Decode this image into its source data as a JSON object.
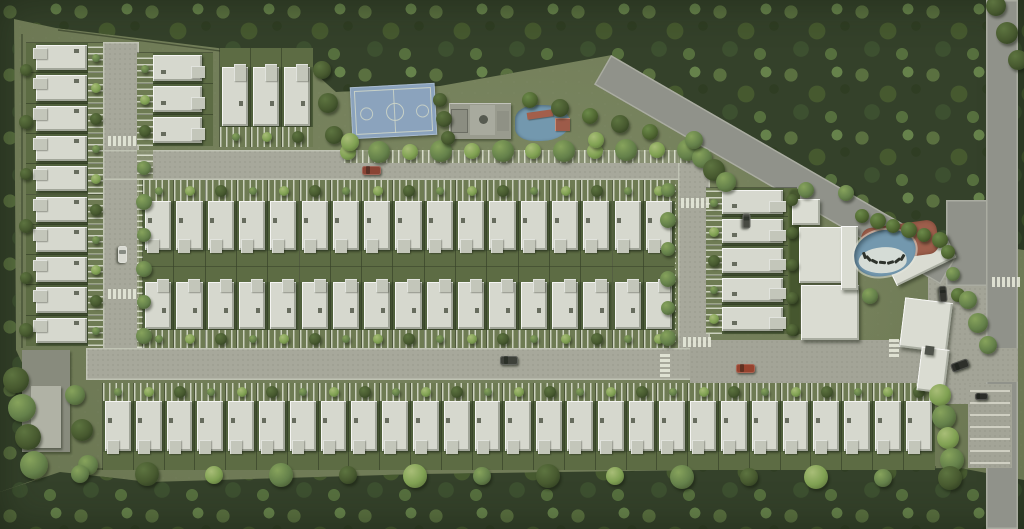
{
  "canvas": {
    "w": 1024,
    "h": 529
  },
  "palette": {
    "grass": "#75815a",
    "forest": "#34412a",
    "asphalt": "#90928a",
    "paver": "#a7a89b",
    "plaza": "#a3a497",
    "roof_white": "#d6d8ce",
    "yard_green": "#5d6c44",
    "court_blue": "#8ba3bd",
    "court_line": "#d6dbc8",
    "pool_blue": "#7398ae",
    "deck_terracotta": "#9d5f4c",
    "pool_rim": "#e3e5da",
    "wall_line": "#333d26",
    "car_red": "#8a4434",
    "car_dark": "#3e413a",
    "car_white": "#d8d9d1"
  },
  "forest_shapes": [
    {
      "name": "forest-top",
      "points": [
        [
          0,
          0
        ],
        [
          1024,
          0
        ],
        [
          1024,
          250
        ],
        [
          900,
          232
        ],
        [
          612,
          55
        ],
        [
          440,
          86
        ],
        [
          336,
          92
        ],
        [
          298,
          58
        ],
        [
          56,
          28
        ],
        [
          0,
          16
        ]
      ]
    },
    {
      "name": "forest-bottom",
      "points": [
        [
          0,
          492
        ],
        [
          60,
          472
        ],
        [
          150,
          482
        ],
        [
          420,
          474
        ],
        [
          700,
          470
        ],
        [
          960,
          468
        ],
        [
          1024,
          480
        ],
        [
          1024,
          529
        ],
        [
          0,
          529
        ]
      ]
    },
    {
      "name": "forest-left",
      "points": [
        [
          0,
          16
        ],
        [
          14,
          16
        ],
        [
          16,
          350
        ],
        [
          30,
          380
        ],
        [
          34,
          480
        ],
        [
          0,
          492
        ]
      ]
    }
  ],
  "roads": [
    {
      "name": "left-road",
      "x": 103,
      "y": 42,
      "w": 36,
      "h": 338,
      "kind": "paver"
    },
    {
      "name": "top-road",
      "x": 103,
      "y": 150,
      "w": 607,
      "h": 30,
      "kind": "paver"
    },
    {
      "name": "middle-road",
      "x": 678,
      "y": 150,
      "w": 32,
      "h": 230,
      "kind": "paver"
    },
    {
      "name": "bottom-road",
      "x": 86,
      "y": 348,
      "w": 612,
      "h": 32,
      "kind": "paver"
    },
    {
      "name": "entry-plaza",
      "x": 690,
      "y": 340,
      "w": 302,
      "h": 62,
      "kind": "plaza"
    },
    {
      "name": "clubhouse-parking",
      "x": 928,
      "y": 252,
      "w": 64,
      "h": 152,
      "kind": "plaza"
    },
    {
      "name": "junction-filler",
      "x": 946,
      "y": 200,
      "w": 72,
      "h": 86,
      "kind": "asphalt"
    },
    {
      "name": "main-diagonal-road",
      "x": 611,
      "y": 55,
      "w": 400,
      "h": 34,
      "rot": 30,
      "kind": "asphalt"
    },
    {
      "name": "right-road",
      "x": 986,
      "y": 0,
      "w": 32,
      "h": 529,
      "kind": "asphalt"
    },
    {
      "name": "exit-stub",
      "x": 956,
      "y": 348,
      "w": 62,
      "h": 34,
      "kind": "plaza"
    },
    {
      "name": "right-parking",
      "x": 968,
      "y": 384,
      "w": 44,
      "h": 84,
      "kind": "plaza"
    }
  ],
  "lanes": [
    {
      "name": "west-parking-lane",
      "x": 137,
      "y": 150,
      "w": 16,
      "h": 198,
      "dir": "v"
    },
    {
      "name": "east-parking-lane",
      "x": 660,
      "y": 182,
      "w": 16,
      "h": 160,
      "dir": "v"
    },
    {
      "name": "north-parking-lane",
      "x": 344,
      "y": 150,
      "w": 346,
      "h": 13,
      "dir": "h"
    }
  ],
  "house_groups": [
    {
      "name": "left-column",
      "orient": "E",
      "x": 26,
      "y": 42,
      "count": 10,
      "pitch": 30.3,
      "depths": {
        "yard": 10,
        "roof": 52,
        "drive": 15
      }
    },
    {
      "name": "inner-west-column",
      "orient": "W",
      "x": 137,
      "y": 52,
      "count": 3,
      "pitch": 31,
      "depths": {
        "drive": 16,
        "roof": 50,
        "yard": 10
      }
    },
    {
      "name": "north-trio-row",
      "orient": "S",
      "x": 219,
      "y": 48,
      "count": 3,
      "pitch": 31,
      "depths": {
        "yard": 19,
        "roof": 60,
        "drive": 20
      }
    },
    {
      "name": "center-north-row",
      "orient": "N",
      "x": 142,
      "y": 180,
      "count": 17,
      "pitch": 31.3,
      "depths": {
        "drive": 21,
        "roof": 50,
        "yard": 16
      }
    },
    {
      "name": "center-south-row",
      "orient": "S",
      "x": 142,
      "y": 267,
      "count": 17,
      "pitch": 31.3,
      "depths": {
        "yard": 15,
        "roof": 48,
        "drive": 18
      }
    },
    {
      "name": "south-row",
      "orient": "N",
      "x": 102,
      "y": 383,
      "count": 27,
      "pitch": 30.8,
      "depths": {
        "drive": 18,
        "roof": 51,
        "yard": 18
      }
    },
    {
      "name": "east-column",
      "orient": "W",
      "x": 706,
      "y": 187,
      "count": 5,
      "pitch": 29.2,
      "depths": {
        "drive": 16,
        "roof": 62,
        "yard": 13
      }
    }
  ],
  "buildings": [
    {
      "name": "clubhouse-pavilion",
      "x": 792,
      "y": 199,
      "w": 28,
      "h": 26
    },
    {
      "name": "clubhouse-hall-north",
      "x": 799,
      "y": 227,
      "w": 46,
      "h": 56
    },
    {
      "name": "clubhouse-hall-south",
      "x": 801,
      "y": 285,
      "w": 58,
      "h": 55
    },
    {
      "name": "clubhouse-slab",
      "x": 841,
      "y": 226,
      "w": 17,
      "h": 64
    },
    {
      "name": "gym-angled-building",
      "x": 888,
      "y": 247,
      "w": 66,
      "h": 26,
      "rot": -26
    },
    {
      "name": "gatehouse-canopy",
      "x": 902,
      "y": 300,
      "w": 48,
      "h": 50,
      "rot": 7
    },
    {
      "name": "gatehouse-wing",
      "x": 919,
      "y": 348,
      "w": 28,
      "h": 44,
      "rot": 7
    },
    {
      "name": "gatehouse-lane-slot",
      "x": 925,
      "y": 346,
      "w": 9,
      "h": 9,
      "rot": 7,
      "bg": "#4e524a"
    },
    {
      "name": "utility-building",
      "x": 22,
      "y": 350,
      "w": 48,
      "h": 102,
      "bg": "#888b7d"
    },
    {
      "name": "utility-roof",
      "x": 31,
      "y": 386,
      "w": 30,
      "h": 62,
      "bg": "#b0b2a5"
    }
  ],
  "amenities": {
    "basketball_court": {
      "x": 351,
      "y": 85,
      "w": 85,
      "h": 52,
      "rot": -3
    },
    "kiosk": {
      "x": 449,
      "y": 103,
      "w": 62,
      "h": 36
    },
    "kids_pool": {
      "x": 515,
      "y": 105,
      "w": 55,
      "h": 36
    },
    "main_pool": {
      "deck": {
        "x": 862,
        "y": 224,
        "w": 76,
        "h": 34,
        "rot": -8
      },
      "water": {
        "x": 854,
        "y": 230,
        "w": 62,
        "h": 46
      },
      "loungers": {
        "count": 7,
        "cx": 884,
        "cy": 251,
        "rx": 21,
        "ry": 12,
        "a0": 200,
        "a1": 330
      }
    }
  },
  "hedges": [
    {
      "name": "east-column-hedge",
      "x": 788,
      "y": 188,
      "w": 12,
      "h": 148
    }
  ],
  "median_fence": {
    "x": 142,
    "y": 266,
    "w": 532,
    "h": 1.2
  },
  "walls": [
    [
      58,
      30,
      306,
      62
    ],
    [
      22,
      34,
      22,
      348
    ],
    [
      96,
      469,
      936,
      467
    ],
    [
      800,
      188,
      800,
      334
    ]
  ],
  "tree_rows": [
    {
      "x1": 348,
      "y1": 152,
      "x2": 688,
      "y2": 150,
      "n": 12,
      "r": [
        8,
        11
      ],
      "p": [
        "light",
        "mid"
      ]
    },
    {
      "x1": 144,
      "y1": 168,
      "x2": 144,
      "y2": 336,
      "n": 6,
      "r": [
        7,
        8
      ],
      "p": [
        "mid"
      ]
    },
    {
      "x1": 668,
      "y1": 190,
      "x2": 668,
      "y2": 338,
      "n": 6,
      "r": [
        7,
        8
      ],
      "p": [
        "mid"
      ]
    },
    {
      "x1": 530,
      "y1": 100,
      "x2": 650,
      "y2": 132,
      "n": 5,
      "r": [
        8,
        9
      ],
      "p": [
        "palm",
        "dark"
      ]
    },
    {
      "x1": 702,
      "y1": 158,
      "x2": 726,
      "y2": 182,
      "n": 3,
      "r": [
        10,
        11
      ],
      "p": [
        "mid",
        "dark"
      ]
    },
    {
      "x1": 862,
      "y1": 216,
      "x2": 940,
      "y2": 240,
      "n": 6,
      "r": [
        7,
        8
      ],
      "p": [
        "palm"
      ]
    },
    {
      "x1": 948,
      "y1": 252,
      "x2": 958,
      "y2": 295,
      "n": 3,
      "r": [
        7,
        7
      ],
      "p": [
        "palm",
        "mid"
      ]
    },
    {
      "x1": 940,
      "y1": 395,
      "x2": 952,
      "y2": 460,
      "n": 4,
      "r": [
        11,
        12
      ],
      "p": [
        "light",
        "mid"
      ]
    },
    {
      "x1": 968,
      "y1": 300,
      "x2": 988,
      "y2": 345,
      "n": 3,
      "r": [
        9,
        10
      ],
      "p": [
        "mid"
      ]
    },
    {
      "x1": 26,
      "y1": 70,
      "x2": 26,
      "y2": 330,
      "n": 6,
      "r": [
        6,
        7
      ],
      "p": [
        "dark"
      ]
    },
    {
      "x1": 16,
      "y1": 380,
      "x2": 34,
      "y2": 465,
      "n": 4,
      "r": [
        13,
        14
      ],
      "p": [
        "dark",
        "mid"
      ]
    },
    {
      "x1": 75,
      "y1": 395,
      "x2": 88,
      "y2": 465,
      "n": 3,
      "r": [
        10,
        11
      ],
      "p": [
        "mid",
        "dark"
      ]
    },
    {
      "x1": 440,
      "y1": 100,
      "x2": 448,
      "y2": 138,
      "n": 3,
      "r": [
        7,
        8
      ],
      "p": [
        "dark"
      ]
    },
    {
      "x1": 80,
      "y1": 474,
      "x2": 950,
      "y2": 478,
      "n": 14,
      "r": [
        9,
        12
      ],
      "p": [
        "mid",
        "dark",
        "light"
      ]
    },
    {
      "x1": 996,
      "y1": 6,
      "x2": 1018,
      "y2": 60,
      "n": 3,
      "r": [
        10,
        11
      ],
      "p": [
        "dark"
      ]
    },
    {
      "x1": 322,
      "y1": 70,
      "x2": 334,
      "y2": 135,
      "n": 3,
      "r": [
        9,
        10
      ],
      "p": [
        "dark"
      ]
    },
    {
      "x1": 806,
      "y1": 190,
      "x2": 846,
      "y2": 193,
      "n": 2,
      "r": [
        8,
        8
      ],
      "p": [
        "mid"
      ]
    },
    {
      "x1": 792,
      "y1": 200,
      "x2": 792,
      "y2": 330,
      "n": 5,
      "r": [
        6,
        6
      ],
      "p": [
        "dark"
      ]
    }
  ],
  "trees": [
    {
      "x": 350,
      "y": 142,
      "r": 9,
      "p": "light"
    },
    {
      "x": 694,
      "y": 140,
      "r": 9,
      "p": "mid"
    },
    {
      "x": 870,
      "y": 296,
      "r": 8,
      "p": "mid"
    },
    {
      "x": 596,
      "y": 140,
      "r": 8,
      "p": "light"
    }
  ],
  "cars": [
    {
      "name": "red-car-top-road",
      "cx": 371,
      "cy": 170,
      "w": 19,
      "h": 9,
      "rot": 0,
      "color": "#8a4434"
    },
    {
      "name": "white-van-left-road",
      "cx": 122,
      "cy": 254,
      "w": 17,
      "h": 9,
      "rot": 90,
      "color": "#d8d9d1"
    },
    {
      "name": "dark-car-bottom-road",
      "cx": 509,
      "cy": 360,
      "w": 18,
      "h": 9,
      "rot": 0,
      "color": "#3e413a"
    },
    {
      "name": "red-car-plaza",
      "cx": 745,
      "cy": 368,
      "w": 19,
      "h": 9,
      "rot": 0,
      "color": "#96432e"
    },
    {
      "name": "dark-car-gate",
      "cx": 960,
      "cy": 365,
      "w": 18,
      "h": 9,
      "rot": -20,
      "color": "#2d2f2a"
    },
    {
      "name": "parked-car-clubhouse",
      "cx": 943,
      "cy": 294,
      "w": 16,
      "h": 8,
      "rot": 85,
      "color": "#33352f"
    },
    {
      "name": "parked-car-stalls",
      "cx": 981,
      "cy": 396,
      "w": 13,
      "h": 7,
      "rot": 0,
      "color": "#2c2d29"
    },
    {
      "name": "parked-car-east-drive",
      "cx": 746,
      "cy": 221,
      "w": 15,
      "h": 8,
      "rot": 90,
      "color": "#474a42"
    }
  ],
  "crosswalks": [
    {
      "x": 108,
      "y": 136,
      "dir": "row",
      "n": 6
    },
    {
      "x": 108,
      "y": 289,
      "dir": "row",
      "n": 6
    },
    {
      "x": 681,
      "y": 198,
      "dir": "row",
      "n": 6
    },
    {
      "x": 683,
      "y": 337,
      "dir": "row",
      "n": 6
    },
    {
      "x": 660,
      "y": 354,
      "dir": "col",
      "n": 5
    },
    {
      "x": 992,
      "y": 277,
      "dir": "row",
      "n": 6
    },
    {
      "x": 889,
      "y": 339,
      "dir": "col",
      "n": 4
    }
  ],
  "parking_lines": [
    {
      "x": 970,
      "y": 390,
      "len": 40,
      "gap": 12,
      "n": 7,
      "dir": "h"
    }
  ],
  "tree_palettes": {
    "light": [
      "#a8bd77",
      "#7fa052",
      "#566b38"
    ],
    "mid": [
      "#87a35c",
      "#64804a",
      "#42532e"
    ],
    "dark": [
      "#5d7440",
      "#47592f",
      "#2c3a1e"
    ],
    "palm": [
      "#6c8a4a",
      "#4f6631",
      "#324020"
    ]
  }
}
